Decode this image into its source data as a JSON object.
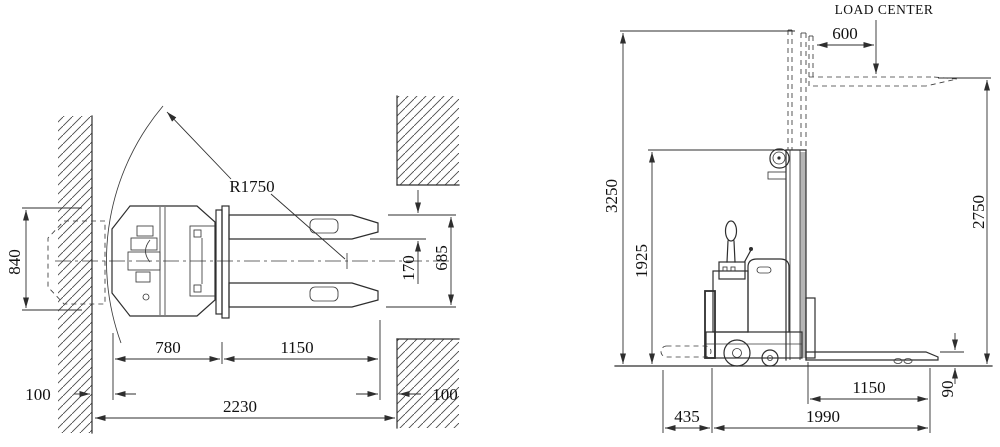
{
  "drawing": {
    "background": "#ffffff",
    "line_color": "#2e2e2e",
    "mast_strip_color": "#b5b5b5",
    "top_view": {
      "dim_overall_width": "840",
      "dim_clearance_left": "100",
      "dim_rear_length": "780",
      "dim_fork_length": "1150",
      "dim_aisle_width": "2230",
      "dim_clearance_right": "100",
      "dim_fork_width": "170",
      "dim_fork_overall_span": "685",
      "dim_turning_radius": "R1750"
    },
    "side_view": {
      "load_center_label": "LOAD CENTER",
      "dim_load_center": "600",
      "dim_max_height": "3250",
      "dim_collapsed_height": "1925",
      "dim_lift_height": "2750",
      "dim_fork_height": "90",
      "dim_fork_length": "1150",
      "dim_overall_length": "1990",
      "dim_tiller_length": "435"
    }
  }
}
